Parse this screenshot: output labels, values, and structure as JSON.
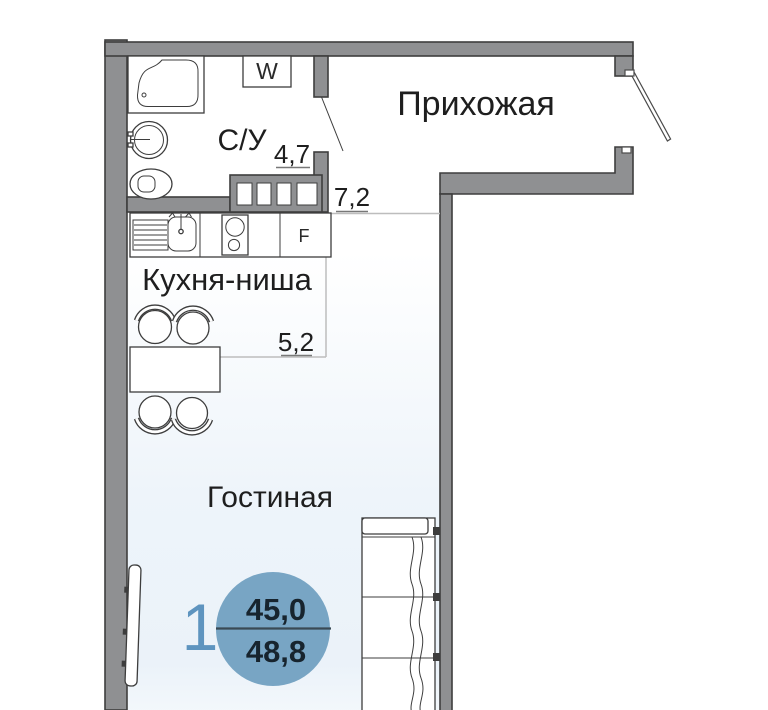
{
  "plan": {
    "rooms": {
      "bathroom": {
        "label": "С/У",
        "area": "4,7"
      },
      "hallway": {
        "label": "Прихожая",
        "area": "7,2"
      },
      "kitchen": {
        "label": "Кухня-ниша",
        "area": "5,2"
      },
      "living": {
        "label": "Гостиная"
      }
    },
    "appliances": {
      "washer_label": "W",
      "fridge_label": "F"
    },
    "info_badge": {
      "room_count": "1",
      "living_area": "45,0",
      "total_area": "48,8"
    }
  },
  "colors": {
    "wall": "#8f9092",
    "wall_outline": "#3e3e3e",
    "line": "#3d3d3d",
    "zone": "#bdbdbd",
    "underline": "#787878",
    "label": "#1e1e1e",
    "badge_fill": "#78a5c4",
    "badge_accent": "#5e94bf",
    "badge_text": "#17242e",
    "badge_divider": "#3a4a55",
    "tint": "#e4eef7"
  }
}
